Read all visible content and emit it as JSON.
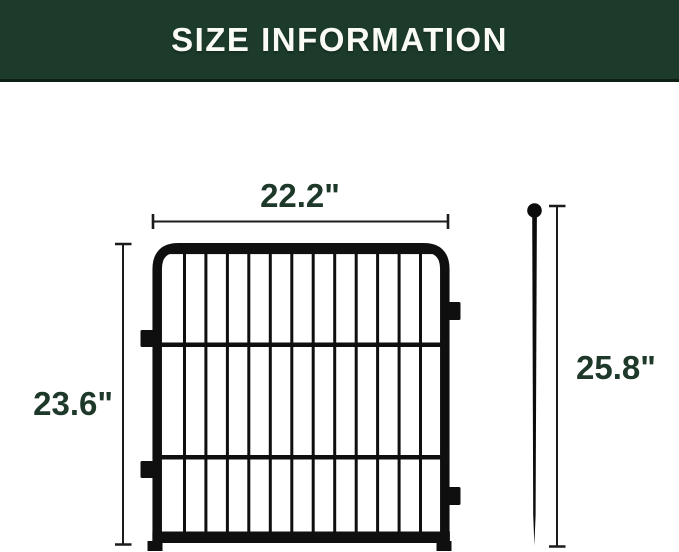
{
  "header": {
    "title": "SIZE INFORMATION"
  },
  "dimensions": {
    "panel_width": "22.2\"",
    "panel_height": "23.6\"",
    "stake_height": "25.8\""
  },
  "panel": {
    "vertical_bars": 12
  },
  "colors": {
    "header_bg": "#1c3b2b",
    "header_text": "#fbfbf6",
    "dimension_text": "#1e392a",
    "fence_black": "#0f0f0f",
    "background": "#ffffff"
  }
}
